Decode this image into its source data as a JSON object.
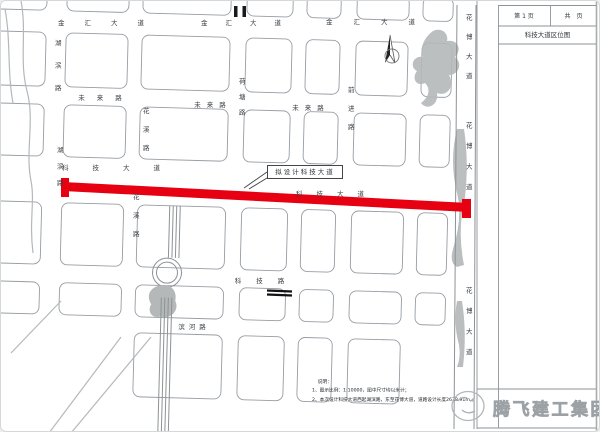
{
  "sheet": {
    "page_label": "第 1 页",
    "pages_label": "共　页",
    "drawing_title": "科技大道区位图"
  },
  "map": {
    "annotation": {
      "label": "拟设计科技大道"
    },
    "road_highlight_color": "#e60012",
    "labels": [
      {
        "text": "金汇大道",
        "x": 110,
        "y": 22,
        "o": "h",
        "ls": 20
      },
      {
        "text": "金汇大道",
        "x": 249,
        "y": 22,
        "o": "h",
        "ls": 18
      },
      {
        "text": "金汇大道",
        "x": 380,
        "y": 21,
        "o": "h",
        "ls": 21
      },
      {
        "text": "未来路",
        "x": 105,
        "y": 97,
        "o": "h",
        "ls": 12
      },
      {
        "text": "未来路",
        "x": 212,
        "y": 104,
        "o": "h",
        "ls": 6
      },
      {
        "text": "未来路",
        "x": 310,
        "y": 107,
        "o": "h",
        "ls": 6
      },
      {
        "text": "科技大道",
        "x": 122,
        "y": 167,
        "o": "h",
        "ls": 24
      },
      {
        "text": "科技大道",
        "x": 336,
        "y": 193,
        "o": "h",
        "ls": 14
      },
      {
        "text": "科技路",
        "x": 266,
        "y": 280,
        "o": "h",
        "ls": 15
      },
      {
        "text": "滨河路",
        "x": 193,
        "y": 326,
        "o": "h",
        "ls": 4
      },
      {
        "text": "湖滨路",
        "x": 56,
        "y": 72,
        "o": "v",
        "ls": 16
      },
      {
        "text": "湖滨路",
        "x": 58,
        "y": 170,
        "o": "v",
        "ls": 10
      },
      {
        "text": "花溪路",
        "x": 144,
        "y": 134,
        "o": "v",
        "ls": 12
      },
      {
        "text": "花溪路",
        "x": 134,
        "y": 220,
        "o": "v",
        "ls": 12
      },
      {
        "text": "荷塘路",
        "x": 240,
        "y": 100,
        "o": "v",
        "ls": 9
      },
      {
        "text": "前进路",
        "x": 349,
        "y": 113,
        "o": "v",
        "ls": 12
      },
      {
        "text": "花博大道",
        "x": 467,
        "y": 52,
        "o": "v",
        "ls": 13
      },
      {
        "text": "花博大道",
        "x": 467,
        "y": 162,
        "o": "v",
        "ls": 14
      },
      {
        "text": "花博大道",
        "x": 467,
        "y": 327,
        "o": "v",
        "ls": 14
      }
    ]
  },
  "notes": {
    "heading": "说明：",
    "items": [
      "1、图示比例：1:10000，图中尺寸均以米计；",
      "2、本次设计科技大道西起湖滨路，东至花博大道，道路设计长度2638.91m。"
    ]
  },
  "footer_logo": {
    "company": "腾飞建工集团"
  },
  "colors": {
    "map_line": "#979da4",
    "water_gray": "#b4b8b9",
    "highlight_red": "#e60012"
  }
}
